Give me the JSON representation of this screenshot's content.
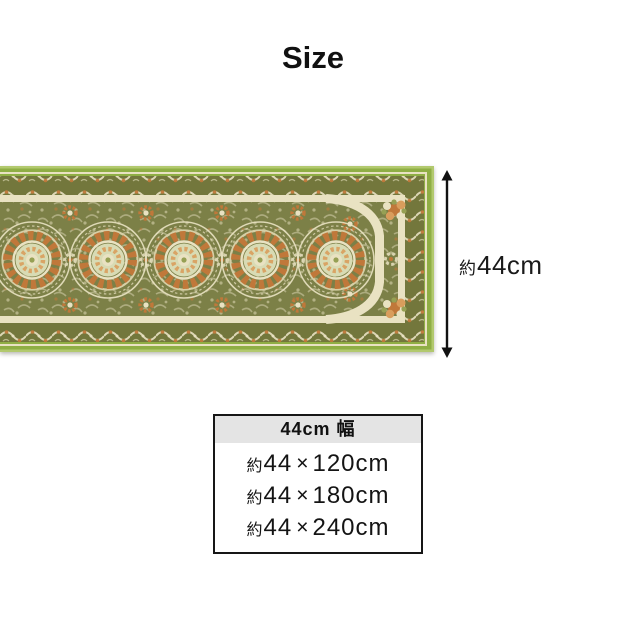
{
  "title": "Size",
  "rug": {
    "style": "green ornamental runner rug with round medallions and arched end",
    "medallion_count": 5
  },
  "dimension_label": {
    "prefix": "約",
    "value": "44cm"
  },
  "size_table": {
    "header": "44cm 幅",
    "rows": [
      {
        "prefix": "約",
        "width": "44",
        "times": "×",
        "length": "120cm"
      },
      {
        "prefix": "約",
        "width": "44",
        "times": "×",
        "length": "180cm"
      },
      {
        "prefix": "約",
        "width": "44",
        "times": "×",
        "length": "240cm"
      }
    ]
  },
  "colors": {
    "page_bg": "#ffffff",
    "ink": "#1e1e1e",
    "table_border": "#161616",
    "header_bg": "#e4e4e4",
    "green_edge": "#8fae44",
    "green_edge_light": "#b2c96e",
    "border_olive": "#73773c",
    "cream": "#e9e2c2",
    "cream_soft": "#d6cfa6",
    "field_olive": "#7c8047",
    "orange": "#c0783a",
    "orange_light": "#d99d5c",
    "celadon": "#d8dbb4",
    "leaf": "#96a054"
  }
}
